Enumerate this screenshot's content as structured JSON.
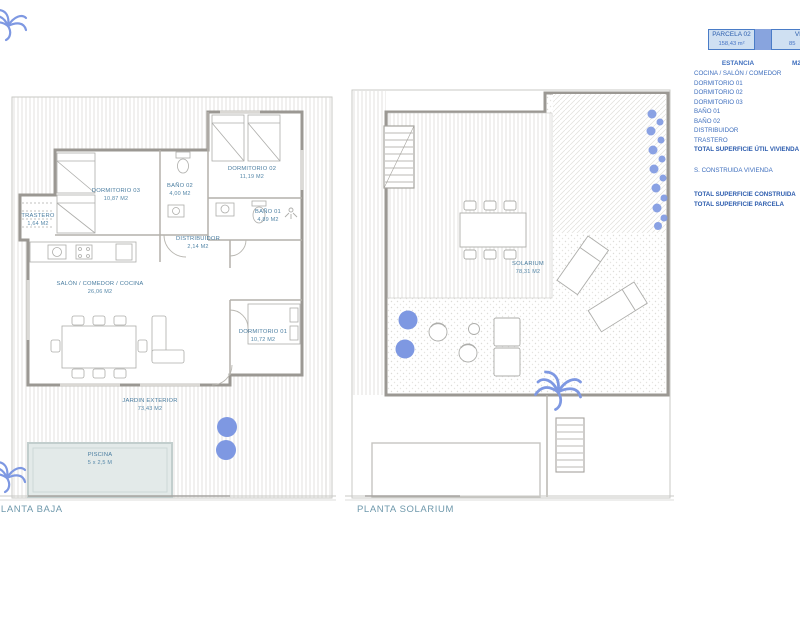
{
  "header": {
    "parcela": {
      "label": "PARCELA 02",
      "value": "158,43 m²"
    },
    "vivienda": {
      "label": "VIVIENDA",
      "value": "85"
    }
  },
  "summary_table": {
    "title": "ESTANCIA",
    "unit": "M2",
    "rows": [
      {
        "label": "COCINA / SALÓN / COMEDOR"
      },
      {
        "label": "DORMITORIO 01"
      },
      {
        "label": "DORMITORIO 02"
      },
      {
        "label": "DORMITORIO 03"
      },
      {
        "label": "BAÑO 01"
      },
      {
        "label": "BAÑO 02"
      },
      {
        "label": "DISTRIBUIDOR"
      },
      {
        "label": "TRASTERO"
      },
      {
        "label": "TOTAL SUPERFICIE ÚTIL VIVIENDA"
      }
    ],
    "extra": [
      {
        "label": "S. CONSTRUIDA VIVIENDA"
      },
      {
        "label": "TOTAL SUPERFICIE CONSTRUIDA"
      },
      {
        "label": "TOTAL SUPERFICIE PARCELA"
      }
    ]
  },
  "plans": {
    "baja": {
      "title": "PLANTA BAJA",
      "rooms": [
        {
          "name": "DORMITORIO 03",
          "area": "10,87 M2"
        },
        {
          "name": "BAÑO 02",
          "area": "4,00 M2"
        },
        {
          "name": "DORMITORIO 02",
          "area": "11,19 M2"
        },
        {
          "name": "BAÑO 01",
          "area": "4,89 M2"
        },
        {
          "name": "DISTRIBUIDOR",
          "area": "2,14 M2"
        },
        {
          "name": "TRASTERO",
          "area": "1,64 M2"
        },
        {
          "name": "SALÓN / COMEDOR / COCINA",
          "area": "26,06 M2"
        },
        {
          "name": "DORMITORIO 01",
          "area": "10,72 M2"
        },
        {
          "name": "JARDIN EXTERIOR",
          "area": "73,43 M2"
        },
        {
          "name": "PISCINA",
          "area": "5 x 2,5 M"
        }
      ]
    },
    "solarium": {
      "title": "PLANTA SOLARIUM",
      "rooms": [
        {
          "name": "SOLARIUM",
          "area": "78,31 M2"
        }
      ]
    }
  },
  "colors": {
    "accent_periwinkle": "#7e98e2",
    "table_text": "#3f6fbe",
    "plan_text": "#4a7da0",
    "box_border": "#4a7cc7",
    "box_fill": "#cfe0f2"
  }
}
